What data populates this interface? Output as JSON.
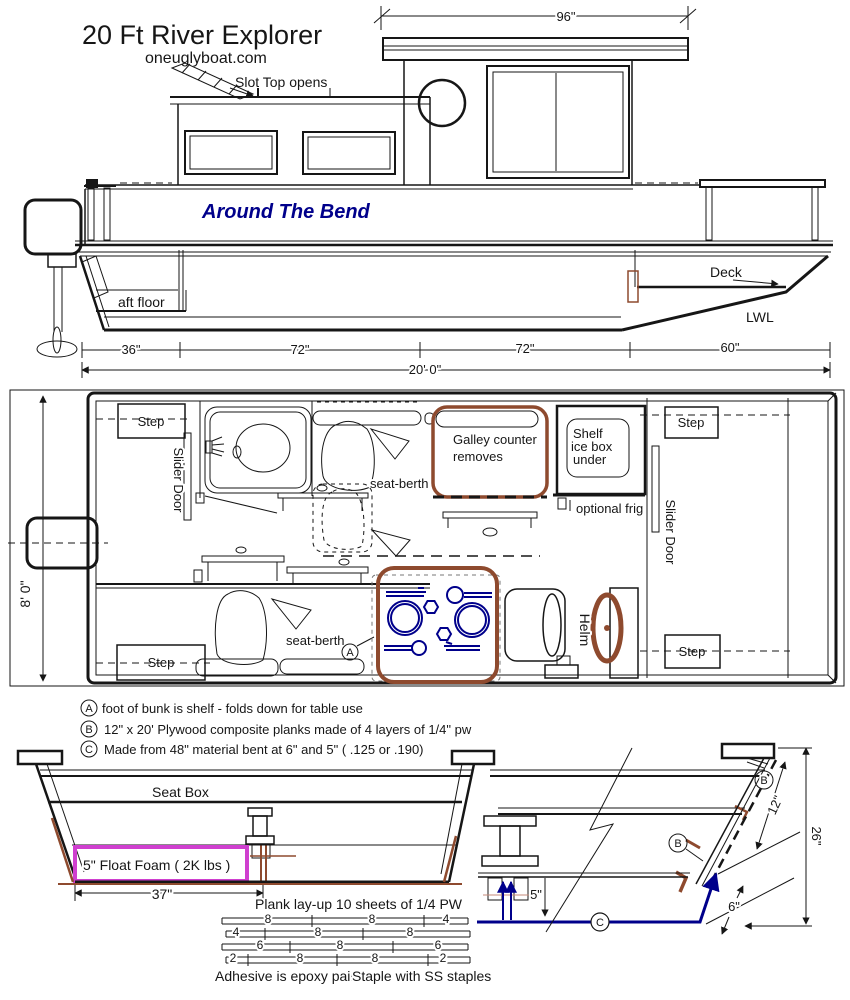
{
  "header": {
    "title": "20 Ft  River Explorer",
    "site": "oneuglyboat.com"
  },
  "colors": {
    "boat_name_blue": "#00008b",
    "accent_brown": "#8e4a2e",
    "foam_magenta": "#cf3fcf",
    "plank_navy": "#00008b"
  },
  "elevation": {
    "boat_name": "Around The Bend",
    "slot_top": "Slot Top opens",
    "aft_floor": "aft floor",
    "deck": "Deck",
    "lwl": "LWL",
    "dim_roof": "96\"",
    "dim_36": "36\"",
    "dim_72a": "72\"",
    "dim_72b": "72\"",
    "dim_60": "60\"",
    "dim_overall": "20' 0\""
  },
  "plan": {
    "step": "Step",
    "slider_door": "Slider Door",
    "seat_berth": "seat-berth",
    "galley_line1": "Galley counter",
    "galley_line2": "removes",
    "shelf_line1": "Shelf",
    "shelf_line2": "ice box",
    "shelf_line3": "under",
    "optional_frig": "optional frig",
    "helm": "Helm",
    "marker_a": "A",
    "dim_beam": "8' 0\""
  },
  "notes": {
    "a_marker": "A",
    "a_text": "foot of bunk is shelf - folds down for table use",
    "b_marker": "B",
    "b_text": "12\" x 20'  Plywood composite  planks  made of 4 layers of 1/4\" pw",
    "c_marker": "C",
    "c_text": "Made from 48\" material bent at 6\" and 5\" ( .125 or .190)"
  },
  "section": {
    "seat_box": "Seat Box",
    "float_foam": "5\"  Float Foam  ( 2K lbs )",
    "dim_37": "37\"",
    "plank_layup": "Plank lay-up 10 sheets of 1/4 PW",
    "dim_12": "12\"",
    "dim_26": "26\"",
    "dim_5": "5\"",
    "dim_6": "6\"",
    "marker_b": "B",
    "marker_c": "C"
  },
  "layup": {
    "rows": [
      [
        "8",
        "8",
        "4"
      ],
      [
        "4",
        "8",
        "8"
      ],
      [
        "6",
        "8",
        "6"
      ],
      [
        "2",
        "8",
        "8",
        "2"
      ]
    ],
    "adhesive": "Adhesive is epoxy paint",
    "staple": "Staple with SS staples"
  }
}
